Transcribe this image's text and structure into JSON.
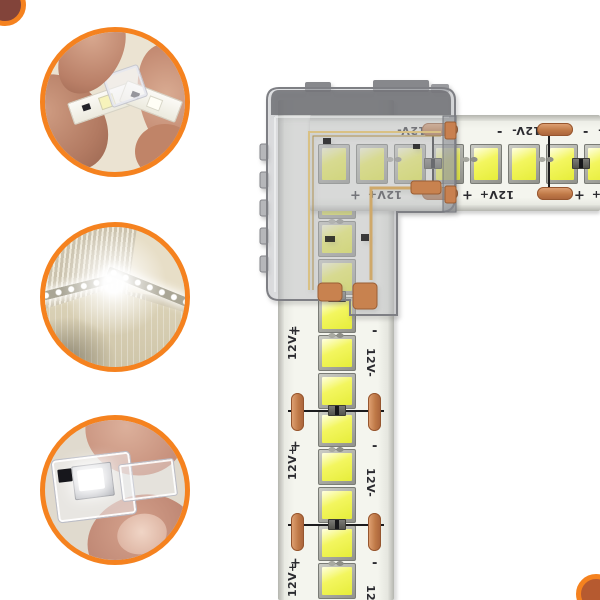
{
  "canvas": {
    "background": "#ffffff",
    "accent_orange": "#f5821f"
  },
  "product": {
    "strip_labels": {
      "positive": "12V+",
      "negative": "12V-",
      "plus": "+",
      "minus": "-"
    },
    "horizontal_strip": {
      "led_count": 8
    },
    "vertical_strip": {
      "led_count": 12
    }
  },
  "insets": [
    {
      "name": "strips-clipped-into-corner-connector"
    },
    {
      "name": "installed-corner-lit"
    },
    {
      "name": "transparent-corner-connector-closeup"
    }
  ],
  "colors": {
    "pcb": "#f4f5ee",
    "led_die": "#f3f65f",
    "copper_pad": "#c07a48",
    "connector_shell": "#7e7f84",
    "label_text": "#2b2b30"
  }
}
